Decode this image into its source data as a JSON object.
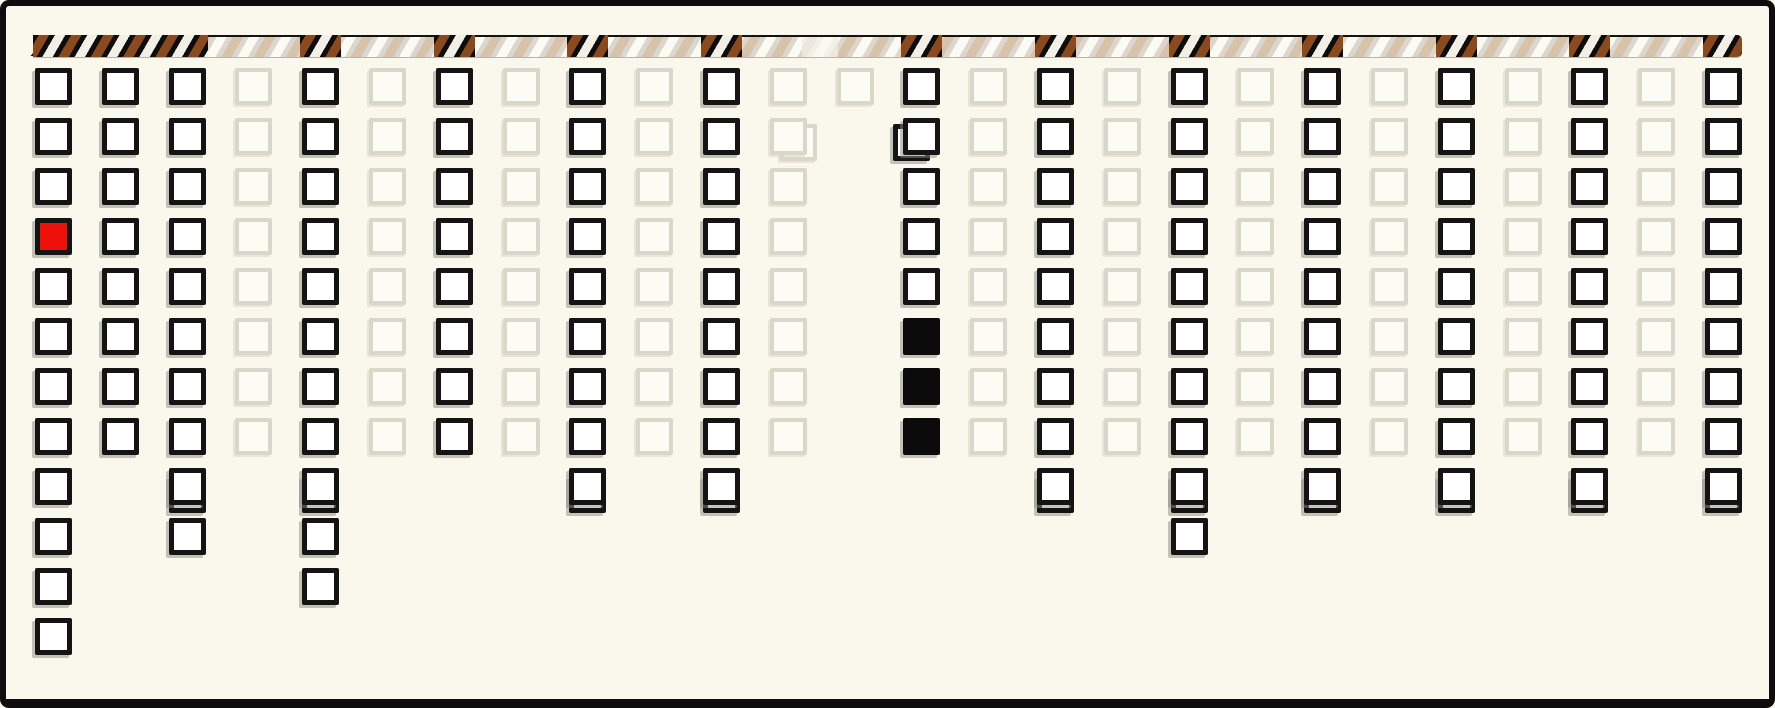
{
  "window": {
    "width": 1775,
    "height": 708,
    "background": "#faf8ec",
    "frame_color": "#0d0d0d"
  },
  "palette": {
    "square_border": "#141414",
    "square_fill_white": "#ffffff",
    "square_fill_red": "#ee1008",
    "square_fill_black": "#0b0b0b",
    "faded_border": "#d9d6ca",
    "faded_fill": "#fdfcf4",
    "bar_black": "#0d0d0d",
    "bar_stripe_brown": "#8a4a1d",
    "bar_stripe_white": "#f2efe7",
    "bar_faded_base": "#dbd7ce",
    "bar_faded_stripe_tan": "#d7c3a9",
    "bar_blank_base": "#f2f0e7"
  },
  "grid": {
    "origin_x": 35,
    "origin_y": 68,
    "pitch_x": 66.8,
    "pitch_y": 50,
    "cell_size": 37,
    "num_columns": 26,
    "main_rows": 8,
    "max_rows": 12
  },
  "conveyor_bar": {
    "x": 33,
    "y": 35,
    "width": 1709,
    "height": 20,
    "dark_segments": [
      {
        "from_col": 1,
        "to_col": 3
      },
      {
        "from_col": 5,
        "to_col": 5
      },
      {
        "from_col": 7,
        "to_col": 7
      },
      {
        "from_col": 9,
        "to_col": 9
      },
      {
        "from_col": 11,
        "to_col": 11
      },
      {
        "from_col": 14,
        "to_col": 14
      },
      {
        "from_col": 16,
        "to_col": 16
      },
      {
        "from_col": 18,
        "to_col": 18
      },
      {
        "from_col": 20,
        "to_col": 20
      },
      {
        "from_col": 22,
        "to_col": 22
      },
      {
        "from_col": 24,
        "to_col": 24
      },
      {
        "from_col": 26,
        "to_col": 26
      }
    ],
    "blank_segment": {
      "x": 802,
      "width": 36
    },
    "left_tail": {
      "x": 33,
      "y": 50,
      "width": 13,
      "height": 6
    }
  },
  "columns": [
    {
      "col": 1,
      "variant": "dark",
      "white": [
        [
          1,
          3
        ],
        [
          5,
          12
        ]
      ],
      "red": [
        4
      ]
    },
    {
      "col": 2,
      "variant": "dark",
      "white": [
        [
          1,
          8
        ]
      ]
    },
    {
      "col": 3,
      "variant": "dark",
      "white": [
        [
          1,
          10
        ]
      ],
      "ghosts": [
        9
      ]
    },
    {
      "col": 4,
      "variant": "faded",
      "faded": [
        [
          1,
          8
        ]
      ]
    },
    {
      "col": 5,
      "variant": "dark",
      "white": [
        [
          1,
          11
        ]
      ],
      "ghosts": [
        9
      ]
    },
    {
      "col": 6,
      "variant": "faded",
      "faded": [
        [
          1,
          8
        ]
      ]
    },
    {
      "col": 7,
      "variant": "dark",
      "white": [
        [
          1,
          8
        ]
      ]
    },
    {
      "col": 8,
      "variant": "faded",
      "faded": [
        [
          1,
          8
        ]
      ]
    },
    {
      "col": 9,
      "variant": "dark",
      "white": [
        [
          1,
          9
        ]
      ],
      "ghosts": [
        9
      ]
    },
    {
      "col": 10,
      "variant": "faded",
      "faded": [
        [
          1,
          8
        ]
      ]
    },
    {
      "col": 11,
      "variant": "dark",
      "white": [
        [
          1,
          9
        ]
      ],
      "ghosts": [
        9
      ]
    },
    {
      "col": 12,
      "variant": "faded",
      "faded": [
        [
          1,
          8
        ]
      ],
      "ghosts": [
        {
          "row": 2,
          "dx": 10,
          "dy": 6
        }
      ]
    },
    {
      "col": 13,
      "variant": "faded",
      "faded": [
        [
          1,
          1
        ]
      ]
    },
    {
      "col": 14,
      "variant": "dark",
      "white": [
        [
          1,
          5
        ]
      ],
      "black": [
        [
          6,
          8
        ]
      ],
      "ghosts": [
        {
          "row": 2,
          "dx": -10,
          "dy": 6
        }
      ]
    },
    {
      "col": 15,
      "variant": "faded",
      "faded": [
        [
          1,
          8
        ]
      ]
    },
    {
      "col": 16,
      "variant": "dark",
      "white": [
        [
          1,
          9
        ]
      ],
      "ghosts": [
        9
      ]
    },
    {
      "col": 17,
      "variant": "faded",
      "faded": [
        [
          1,
          8
        ]
      ]
    },
    {
      "col": 18,
      "variant": "dark",
      "white": [
        [
          1,
          10
        ]
      ],
      "ghosts": [
        9
      ]
    },
    {
      "col": 19,
      "variant": "faded",
      "faded": [
        [
          1,
          8
        ]
      ]
    },
    {
      "col": 20,
      "variant": "dark",
      "white": [
        [
          1,
          9
        ]
      ],
      "ghosts": [
        9
      ]
    },
    {
      "col": 21,
      "variant": "faded",
      "faded": [
        [
          1,
          8
        ]
      ]
    },
    {
      "col": 22,
      "variant": "dark",
      "white": [
        [
          1,
          9
        ]
      ],
      "ghosts": [
        9
      ]
    },
    {
      "col": 23,
      "variant": "faded",
      "faded": [
        [
          1,
          8
        ]
      ]
    },
    {
      "col": 24,
      "variant": "dark",
      "white": [
        [
          1,
          9
        ]
      ],
      "ghosts": [
        9
      ]
    },
    {
      "col": 25,
      "variant": "faded",
      "faded": [
        [
          1,
          8
        ]
      ]
    },
    {
      "col": 26,
      "variant": "dark",
      "white": [
        [
          1,
          9
        ]
      ],
      "ghosts": [
        9
      ]
    }
  ]
}
